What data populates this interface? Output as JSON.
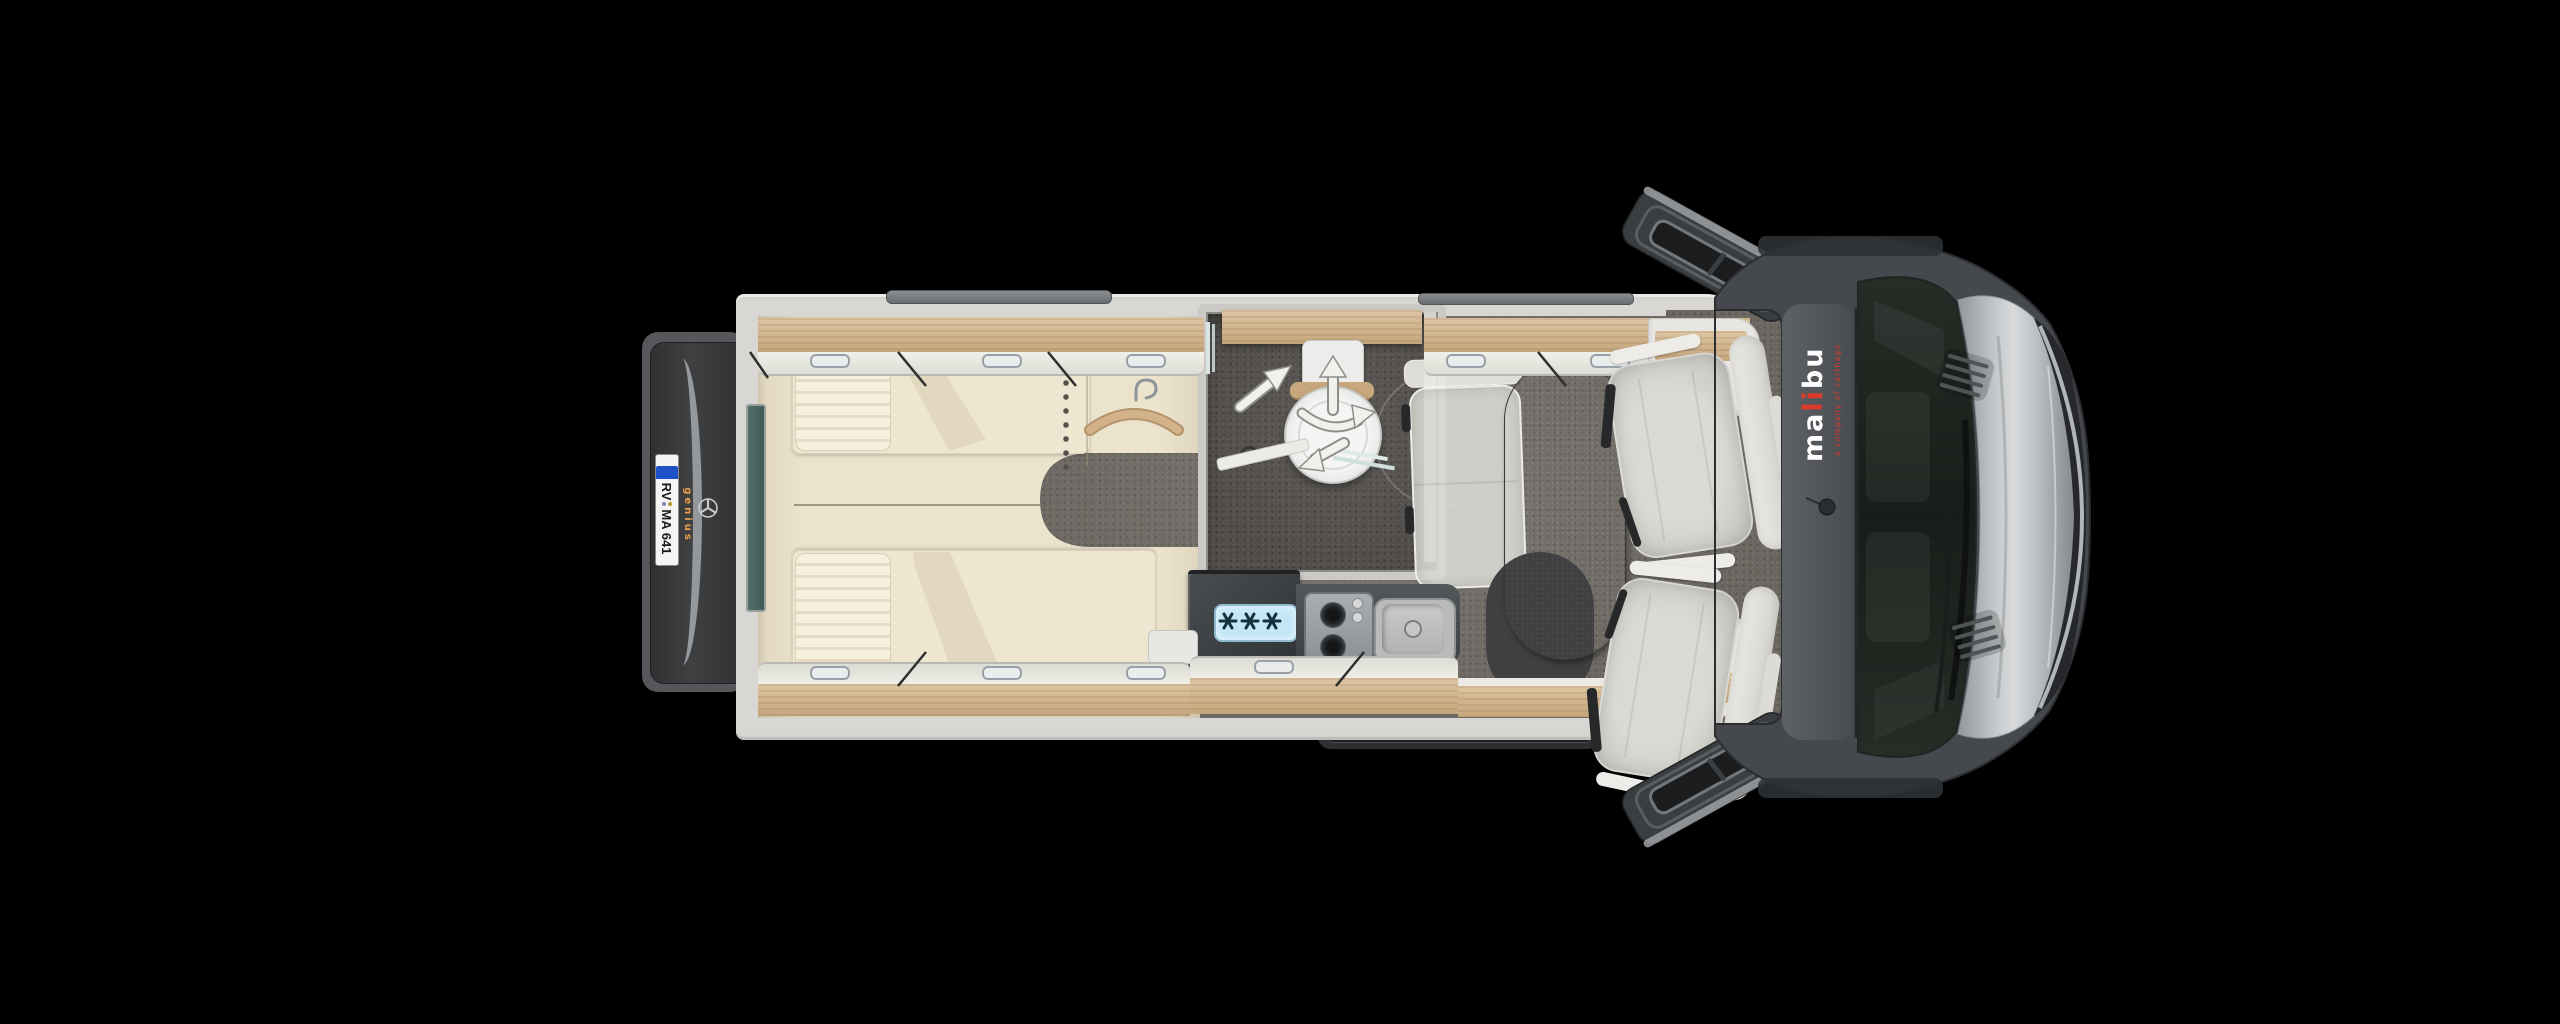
{
  "scene": {
    "title": "Malibu camper van floor plan - top view",
    "background_color": "#000000"
  },
  "branding": {
    "logo_part_left": "ma",
    "logo_part_mid": "li",
    "logo_part_right": "bu",
    "logo_color": "#ffffff",
    "logo_accent_color": "#dd3a2c",
    "logo_tagline": "a company of carthago",
    "rear_badge": "genius",
    "rear_badge_color": "#e89d4e"
  },
  "license_plate": {
    "prefix": "RV",
    "suffix": "MA 641",
    "eu_band_color": "#1e50c8"
  },
  "icons": {
    "mercedes_star": "mercedes-star-icon",
    "clothes_hanger": "clothes-hanger-icon",
    "freezer_stars_count": 3,
    "swivel_arrows": [
      "up",
      "up-right",
      "rotate-right",
      "down-left"
    ]
  },
  "areas": [
    "twin-beds",
    "wardrobe",
    "bathroom",
    "kitchen",
    "dinette",
    "cab"
  ],
  "colors": {
    "wall": "#d8d7d3",
    "wood": "#d2b691",
    "bed_base": "#ece3cd",
    "mattress": "#efe6d1",
    "floor": "#6b6660",
    "bath_floor": "#504d4a",
    "cab_body": "#45484c",
    "hood": "#c9ccce",
    "table": "#4c4e4e",
    "fridge_label": "#c4e7f7"
  }
}
